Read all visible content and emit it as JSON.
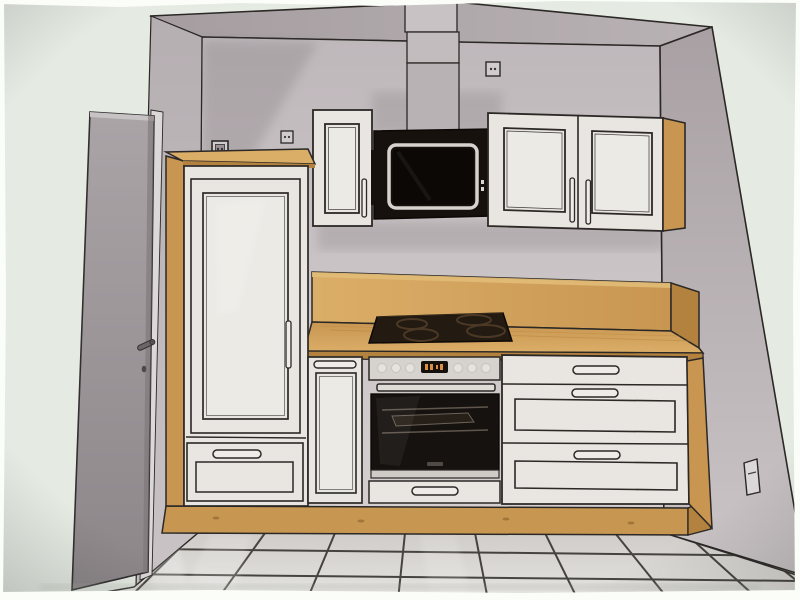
{
  "scene": {
    "subject": "kitchen-design-rendering",
    "socket_count": 4,
    "hood_indicator_lights": 2,
    "cooktop_burners": 4,
    "oven_knobs": 6
  },
  "colors": {
    "paper": "#e5ebe3",
    "paper_edge": "#fbfdf9",
    "soffit_left": "#a59da0",
    "soffit_right": "#b9b2b4",
    "wall_top": "#bfb8bb",
    "wall_bottom": "#d6d0d1",
    "wall_right_top": "#a8a0a3",
    "wall_right_bottom": "#cbc5c7",
    "wall_left_top": "#b6afb2",
    "wall_left_bottom": "#c9c3c5",
    "door_light": "#aaa4a7",
    "door_dark": "#8c8689",
    "door_reveal": "#dcd8d9",
    "duct_upper": "#c8c2c4",
    "duct_mid": "#c3bcbe",
    "duct_lower": "#b9b2b4",
    "cabinet_face": "#e9e6e1",
    "cabinet_panel": "#edebe6",
    "handle_fill": "#efece8",
    "wood_light": "#dcae66",
    "wood_mid": "#c9964f",
    "wood_dark": "#b5823e",
    "plinth": "#c8974f",
    "hood_body": "#17110d",
    "hood_screen": "#0b0806",
    "hood_frame": "#d6d3ce",
    "cooktop": "#231a11",
    "burner_ring": "#4b3926",
    "steel": "#d6d2cd",
    "oven_glass": "#161210",
    "display_bg": "#14100c",
    "display_digits": "#dd8f3e",
    "floor_far": "#cfccc9",
    "floor_near": "#e6e4e1",
    "grout": "#37332f",
    "outline": "#2b2826",
    "socket_face": "#d0cbcd"
  }
}
